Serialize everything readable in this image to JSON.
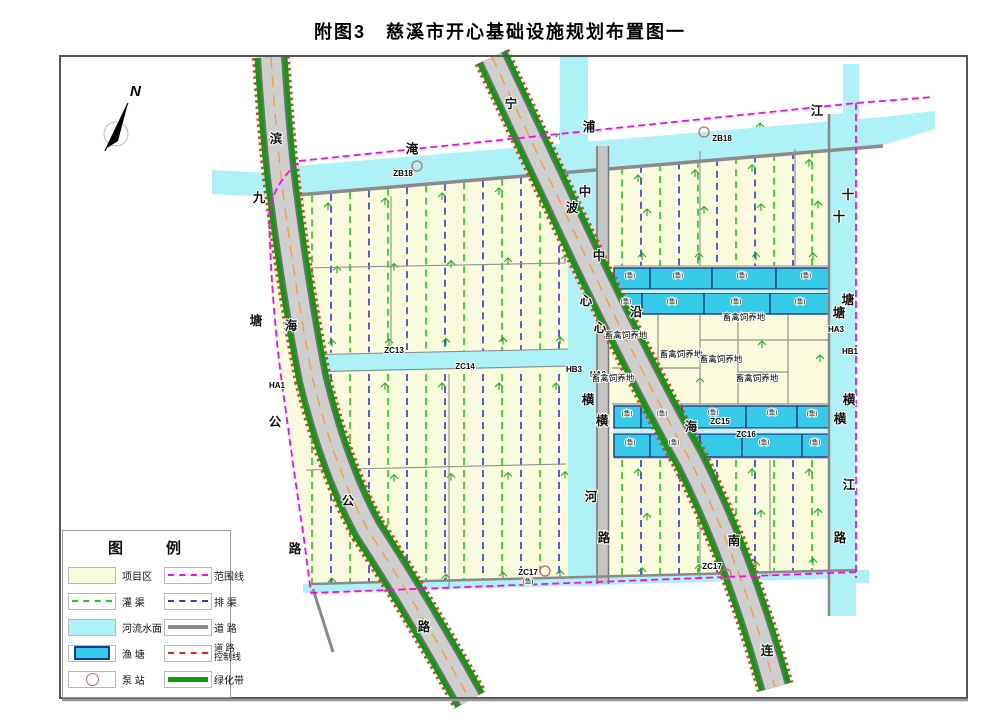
{
  "title": "附图3　慈溪市开心基础设施规划布置图一",
  "north_label": "N",
  "legend": {
    "title": "图　例",
    "items_left": [
      {
        "label": "项目区",
        "type": "project-area"
      },
      {
        "label": "灌  渠",
        "type": "irrigation"
      },
      {
        "label": "河流水面",
        "type": "river"
      },
      {
        "label": "渔  塘",
        "type": "pond"
      },
      {
        "label": "泵  站",
        "type": "pump"
      }
    ],
    "items_right": [
      {
        "label": "范围线",
        "type": "boundary"
      },
      {
        "label": "排  渠",
        "type": "drainage"
      },
      {
        "label": "道  路",
        "type": "road"
      },
      {
        "label": "道  路",
        "label2": "控制线",
        "type": "control"
      },
      {
        "label": "绿化带",
        "type": "greenbelt"
      }
    ]
  },
  "map": {
    "road_labels": [
      {
        "t": "滨",
        "x": 276,
        "y": 143
      },
      {
        "t": "海",
        "x": 291,
        "y": 330
      },
      {
        "t": "公",
        "x": 348,
        "y": 505
      },
      {
        "t": "路",
        "x": 424,
        "y": 631
      },
      {
        "t": "九",
        "x": 259,
        "y": 202
      },
      {
        "t": "塘",
        "x": 256,
        "y": 325
      },
      {
        "t": "公",
        "x": 275,
        "y": 426
      },
      {
        "t": "路",
        "x": 295,
        "y": 553
      },
      {
        "t": "宁",
        "x": 511,
        "y": 108
      },
      {
        "t": "波",
        "x": 572,
        "y": 212
      },
      {
        "t": "沿",
        "x": 636,
        "y": 316
      },
      {
        "t": "海",
        "x": 691,
        "y": 431
      },
      {
        "t": "南",
        "x": 734,
        "y": 545
      },
      {
        "t": "连",
        "x": 767,
        "y": 655
      },
      {
        "t": "淹",
        "x": 412,
        "y": 153
      },
      {
        "t": "浦",
        "x": 589,
        "y": 131
      },
      {
        "t": "江",
        "x": 817,
        "y": 115
      },
      {
        "t": "中",
        "x": 585,
        "y": 196
      },
      {
        "t": "心",
        "x": 586,
        "y": 305
      },
      {
        "t": "横",
        "x": 588,
        "y": 404
      },
      {
        "t": "河",
        "x": 591,
        "y": 501
      },
      {
        "t": "中",
        "x": 599,
        "y": 260
      },
      {
        "t": "心",
        "x": 600,
        "y": 332
      },
      {
        "t": "横",
        "x": 602,
        "y": 425
      },
      {
        "t": "路",
        "x": 604,
        "y": 542
      },
      {
        "t": "十",
        "x": 848,
        "y": 199
      },
      {
        "t": "塘",
        "x": 848,
        "y": 304
      },
      {
        "t": "横",
        "x": 849,
        "y": 404
      },
      {
        "t": "江",
        "x": 849,
        "y": 489
      },
      {
        "t": "十",
        "x": 839,
        "y": 221
      },
      {
        "t": "塘",
        "x": 839,
        "y": 317
      },
      {
        "t": "横",
        "x": 840,
        "y": 423
      },
      {
        "t": "路",
        "x": 840,
        "y": 542
      }
    ],
    "code_labels": [
      {
        "t": "ZB18",
        "x": 403,
        "y": 176
      },
      {
        "t": "ZB18",
        "x": 722,
        "y": 141
      },
      {
        "t": "HA1",
        "x": 277,
        "y": 388
      },
      {
        "t": "ZC13",
        "x": 394,
        "y": 353
      },
      {
        "t": "ZC14",
        "x": 465,
        "y": 369
      },
      {
        "t": "HB3",
        "x": 574,
        "y": 372
      },
      {
        "t": "HA2",
        "x": 598,
        "y": 377
      },
      {
        "t": "HA3",
        "x": 836,
        "y": 332
      },
      {
        "t": "HB1",
        "x": 850,
        "y": 354
      },
      {
        "t": "ZC15",
        "x": 720,
        "y": 424
      },
      {
        "t": "ZC16",
        "x": 746,
        "y": 437
      },
      {
        "t": "ZC17",
        "x": 528,
        "y": 575
      },
      {
        "t": "ZC17",
        "x": 712,
        "y": 569
      }
    ],
    "area_labels": [
      {
        "t": "畜禽饲养地",
        "x": 626,
        "y": 338
      },
      {
        "t": "畜禽饲养地",
        "x": 613,
        "y": 381
      },
      {
        "t": "畜禽饲养地",
        "x": 681,
        "y": 357
      },
      {
        "t": "畜禽饲养地",
        "x": 721,
        "y": 362
      },
      {
        "t": "畜禽饲养地",
        "x": 744,
        "y": 320
      },
      {
        "t": "畜禽饲养地",
        "x": 757,
        "y": 381
      }
    ],
    "pond_labels": [
      {
        "t": "(鱼)",
        "x": 630,
        "y": 277
      },
      {
        "t": "(鱼)",
        "x": 678,
        "y": 277
      },
      {
        "t": "(鱼)",
        "x": 742,
        "y": 277
      },
      {
        "t": "(鱼)",
        "x": 806,
        "y": 277
      },
      {
        "t": "(鱼)",
        "x": 626,
        "y": 303
      },
      {
        "t": "(鱼)",
        "x": 672,
        "y": 303
      },
      {
        "t": "(鱼)",
        "x": 736,
        "y": 303
      },
      {
        "t": "(鱼)",
        "x": 800,
        "y": 303
      },
      {
        "t": "(鱼)",
        "x": 627,
        "y": 415
      },
      {
        "t": "(鱼)",
        "x": 662,
        "y": 415
      },
      {
        "t": "(鱼)",
        "x": 713,
        "y": 414
      },
      {
        "t": "(鱼)",
        "x": 772,
        "y": 414
      },
      {
        "t": "(鱼)",
        "x": 812,
        "y": 415
      },
      {
        "t": "(鱼)",
        "x": 630,
        "y": 444
      },
      {
        "t": "(鱼)",
        "x": 674,
        "y": 444
      },
      {
        "t": "(鱼)",
        "x": 764,
        "y": 444
      },
      {
        "t": "(鱼)",
        "x": 815,
        "y": 444
      },
      {
        "t": "(鱼)",
        "x": 528,
        "y": 583
      }
    ],
    "pump_stations": [
      {
        "x": 417,
        "y": 166
      },
      {
        "x": 704,
        "y": 132
      },
      {
        "x": 545,
        "y": 571
      },
      {
        "x": 726,
        "y": 574
      }
    ]
  },
  "colors": {
    "field": "#fafadc",
    "river": "#aef2f8",
    "pond": "#35cbe9",
    "pond_border": "#1b3a8c",
    "greenbelt": "#0f9b0f",
    "boundary": "#ff00ff",
    "irrigation": "#22c822",
    "drainage": "#3333dd",
    "road_gray": "#8a8a8a",
    "road_fill": "#cfcfcf",
    "control_red": "#ee3333",
    "center_orange": "#ff9933"
  }
}
